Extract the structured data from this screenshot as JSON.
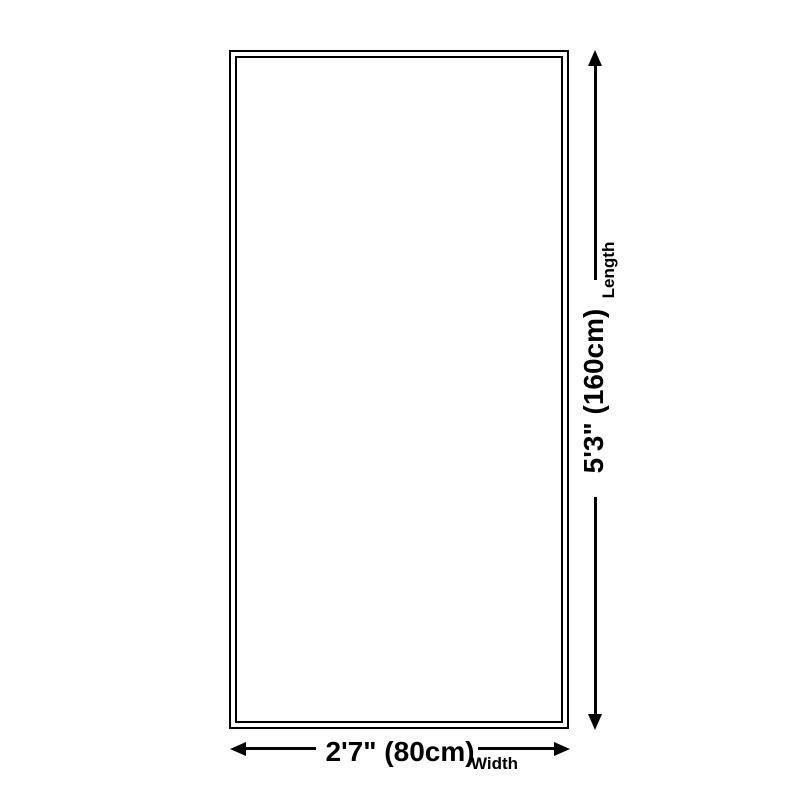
{
  "diagram": {
    "length": {
      "value": "5'3\" (160cm)",
      "label": "Length"
    },
    "width": {
      "value": "2'7\" (80cm)",
      "label": "Width"
    }
  },
  "colors": {
    "line": "#000000",
    "background": "#ffffff"
  }
}
